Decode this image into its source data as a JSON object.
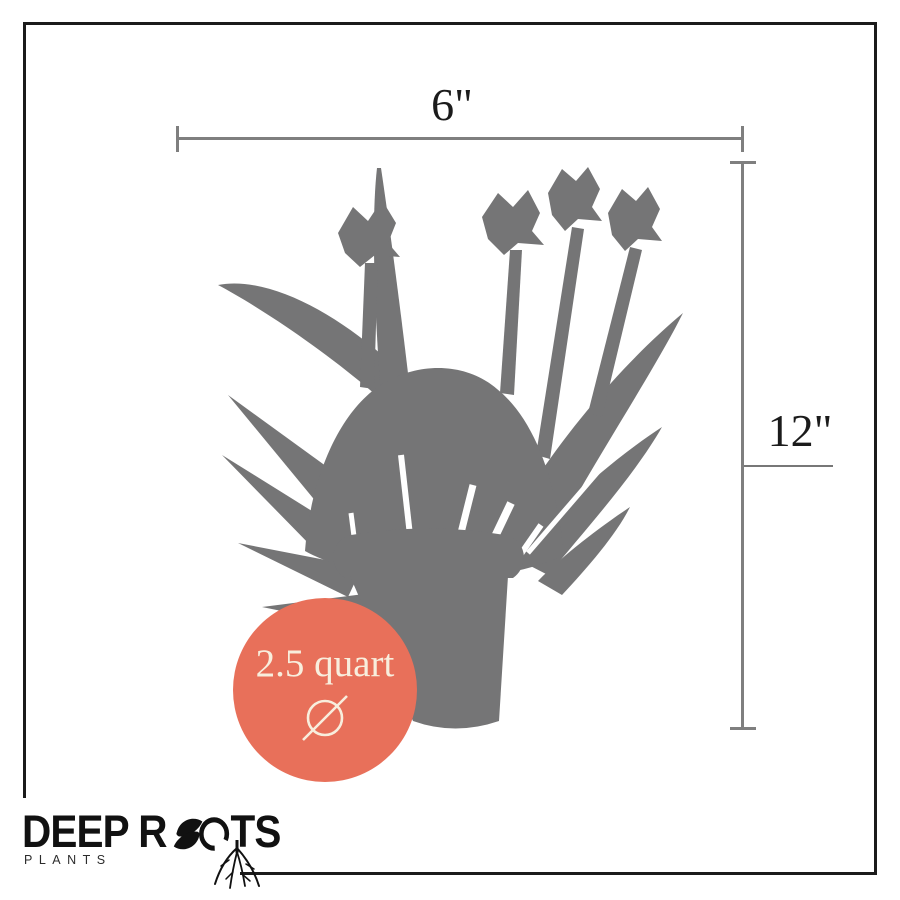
{
  "dimensions": {
    "width_label": "6\"",
    "height_label": "12\""
  },
  "badge": {
    "label": "2.5 quart",
    "symbol_name": "diameter-icon"
  },
  "plant": {
    "description": "gray silhouette of flowering plant in nursery pot"
  },
  "logo": {
    "brand_part1": "DEEP R",
    "brand_part2": "TS",
    "brand_full": "DEEP ROOTS",
    "subtitle": "PLANTS"
  },
  "colors": {
    "coral": "#E8705A",
    "cream": "#F8EEDD",
    "plant-gray": "#757576",
    "line-gray": "#7f7f7f",
    "ink": "#1b1b1b"
  }
}
